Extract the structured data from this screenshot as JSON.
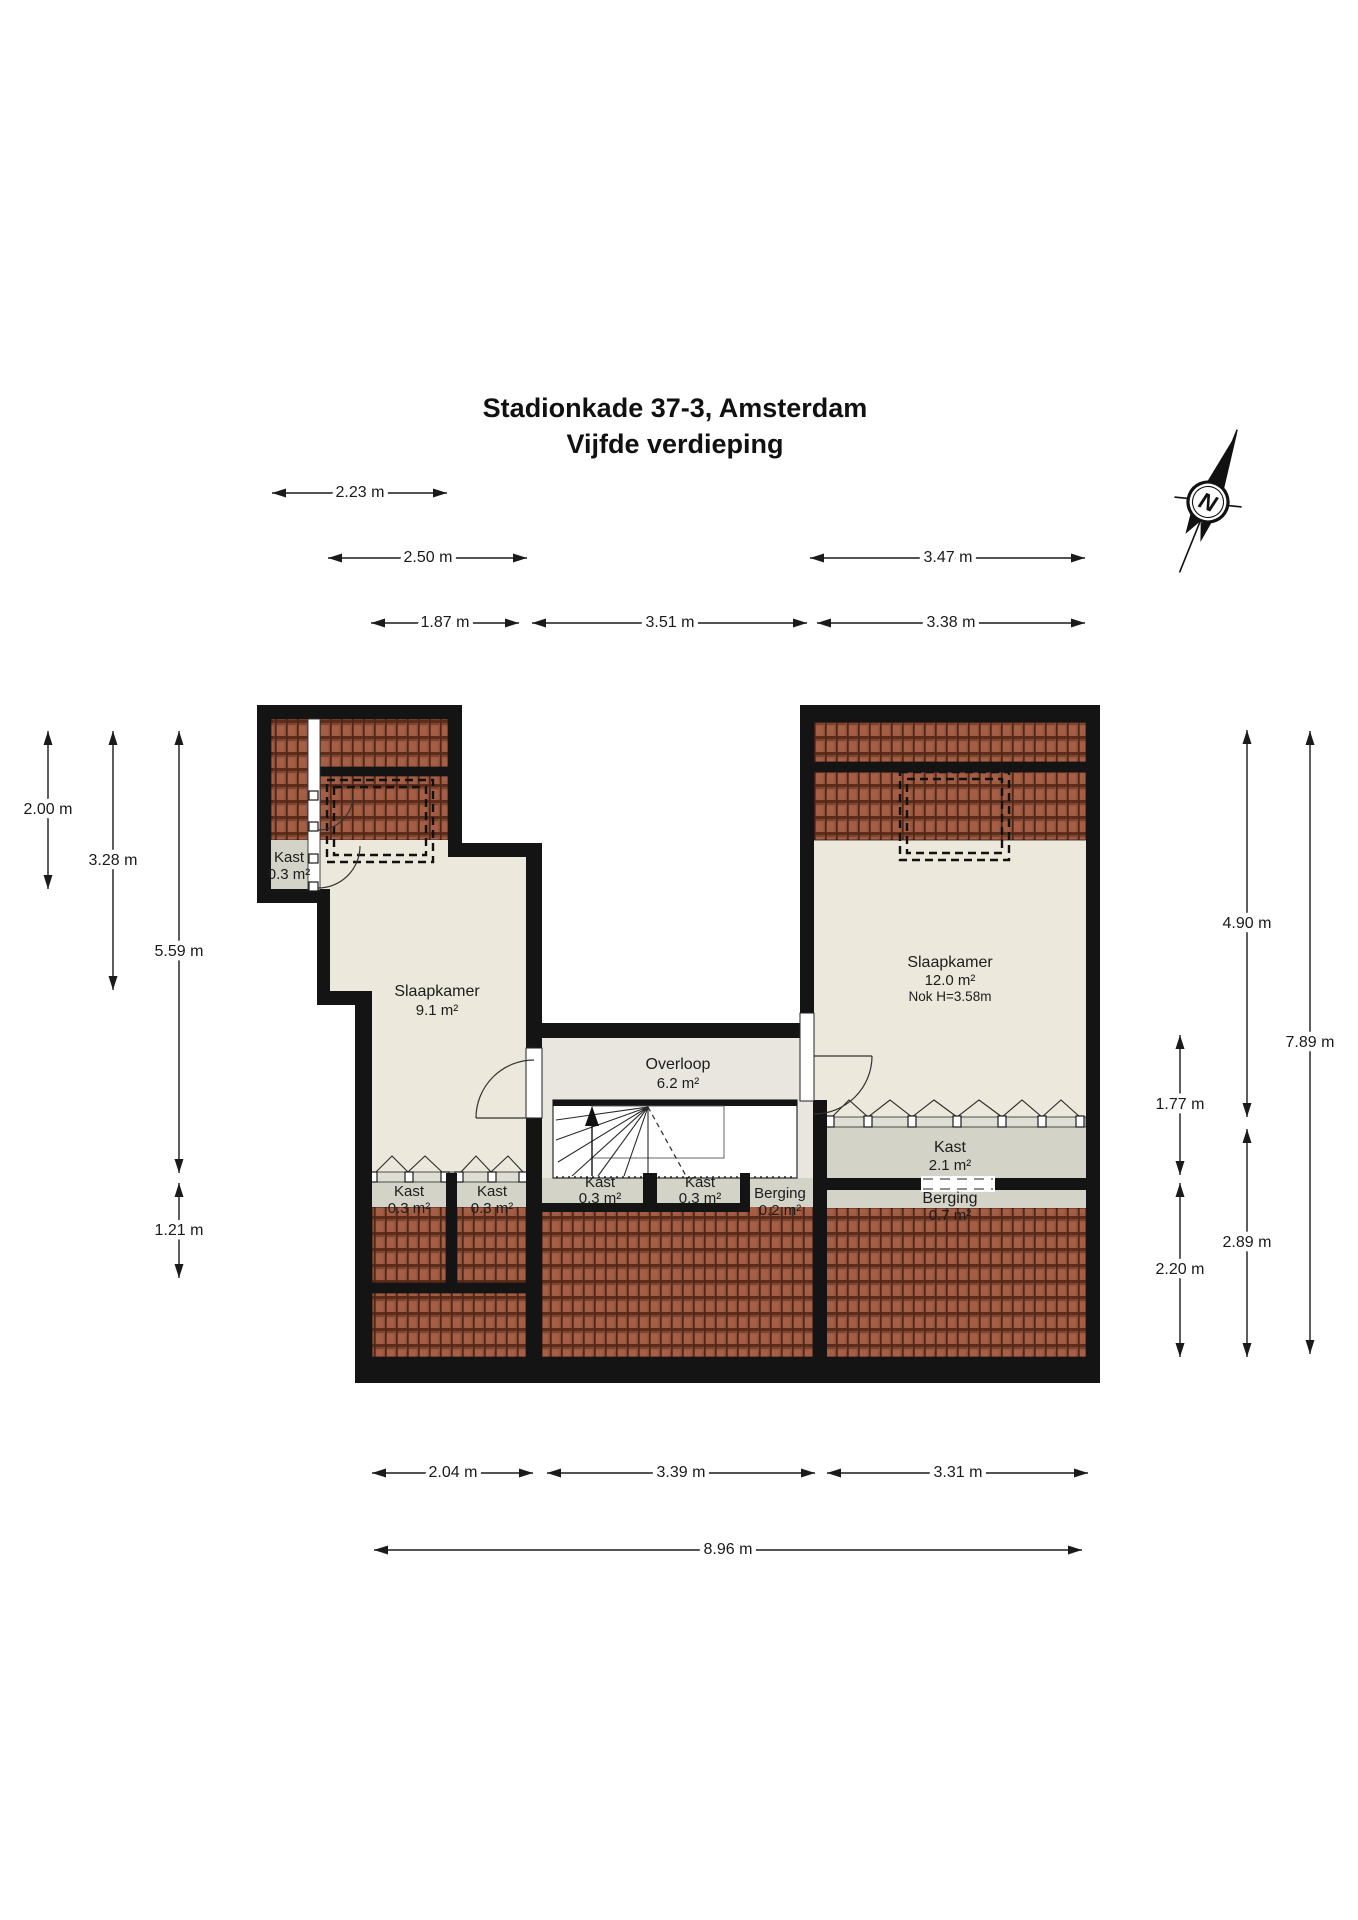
{
  "title": {
    "line1": "Stadionkade 37-3, Amsterdam",
    "line2": "Vijfde verdieping"
  },
  "compass": {
    "label": "N"
  },
  "rooms": {
    "kast_attic": {
      "name": "Kast",
      "area": "0.3 m²"
    },
    "slaapkamer_left": {
      "name": "Slaapkamer",
      "area": "9.1 m²"
    },
    "overloop": {
      "name": "Overloop",
      "area": "6.2 m²"
    },
    "slaapkamer_right": {
      "name": "Slaapkamer",
      "area": "12.0 m²",
      "note": "Nok H=3.58m"
    },
    "kast_1": {
      "name": "Kast",
      "area": "0.3 m²"
    },
    "kast_2": {
      "name": "Kast",
      "area": "0.3 m²"
    },
    "kast_3": {
      "name": "Kast",
      "area": "0.3 m²"
    },
    "kast_4": {
      "name": "Kast",
      "area": "0.3 m²"
    },
    "berging_small": {
      "name": "Berging",
      "area": "0.2 m²"
    },
    "kast_right": {
      "name": "Kast",
      "area": "2.1 m²"
    },
    "berging_right": {
      "name": "Berging",
      "area": "0.7 m²"
    }
  },
  "dimensions": {
    "top": [
      {
        "label": "2.23 m"
      },
      {
        "label": "2.50 m"
      },
      {
        "label": "3.47 m"
      },
      {
        "label": "1.87 m"
      },
      {
        "label": "3.51 m"
      },
      {
        "label": "3.38 m"
      }
    ],
    "left": [
      {
        "label": "2.00 m"
      },
      {
        "label": "3.28 m"
      },
      {
        "label": "5.59 m"
      },
      {
        "label": "1.21 m"
      }
    ],
    "right": [
      {
        "label": "4.90 m"
      },
      {
        "label": "1.77 m"
      },
      {
        "label": "2.89 m"
      },
      {
        "label": "2.20 m"
      },
      {
        "label": "7.89 m"
      }
    ],
    "bottom": [
      {
        "label": "2.04 m"
      },
      {
        "label": "3.39 m"
      },
      {
        "label": "3.31 m"
      },
      {
        "label": "8.96 m"
      }
    ]
  },
  "colors": {
    "wall": "#141414",
    "beige": "#ece8db",
    "overloop": "#e8e6df",
    "closet": "#d3d3c8",
    "sill": "#dfded4",
    "text": "#1a1a1a"
  }
}
